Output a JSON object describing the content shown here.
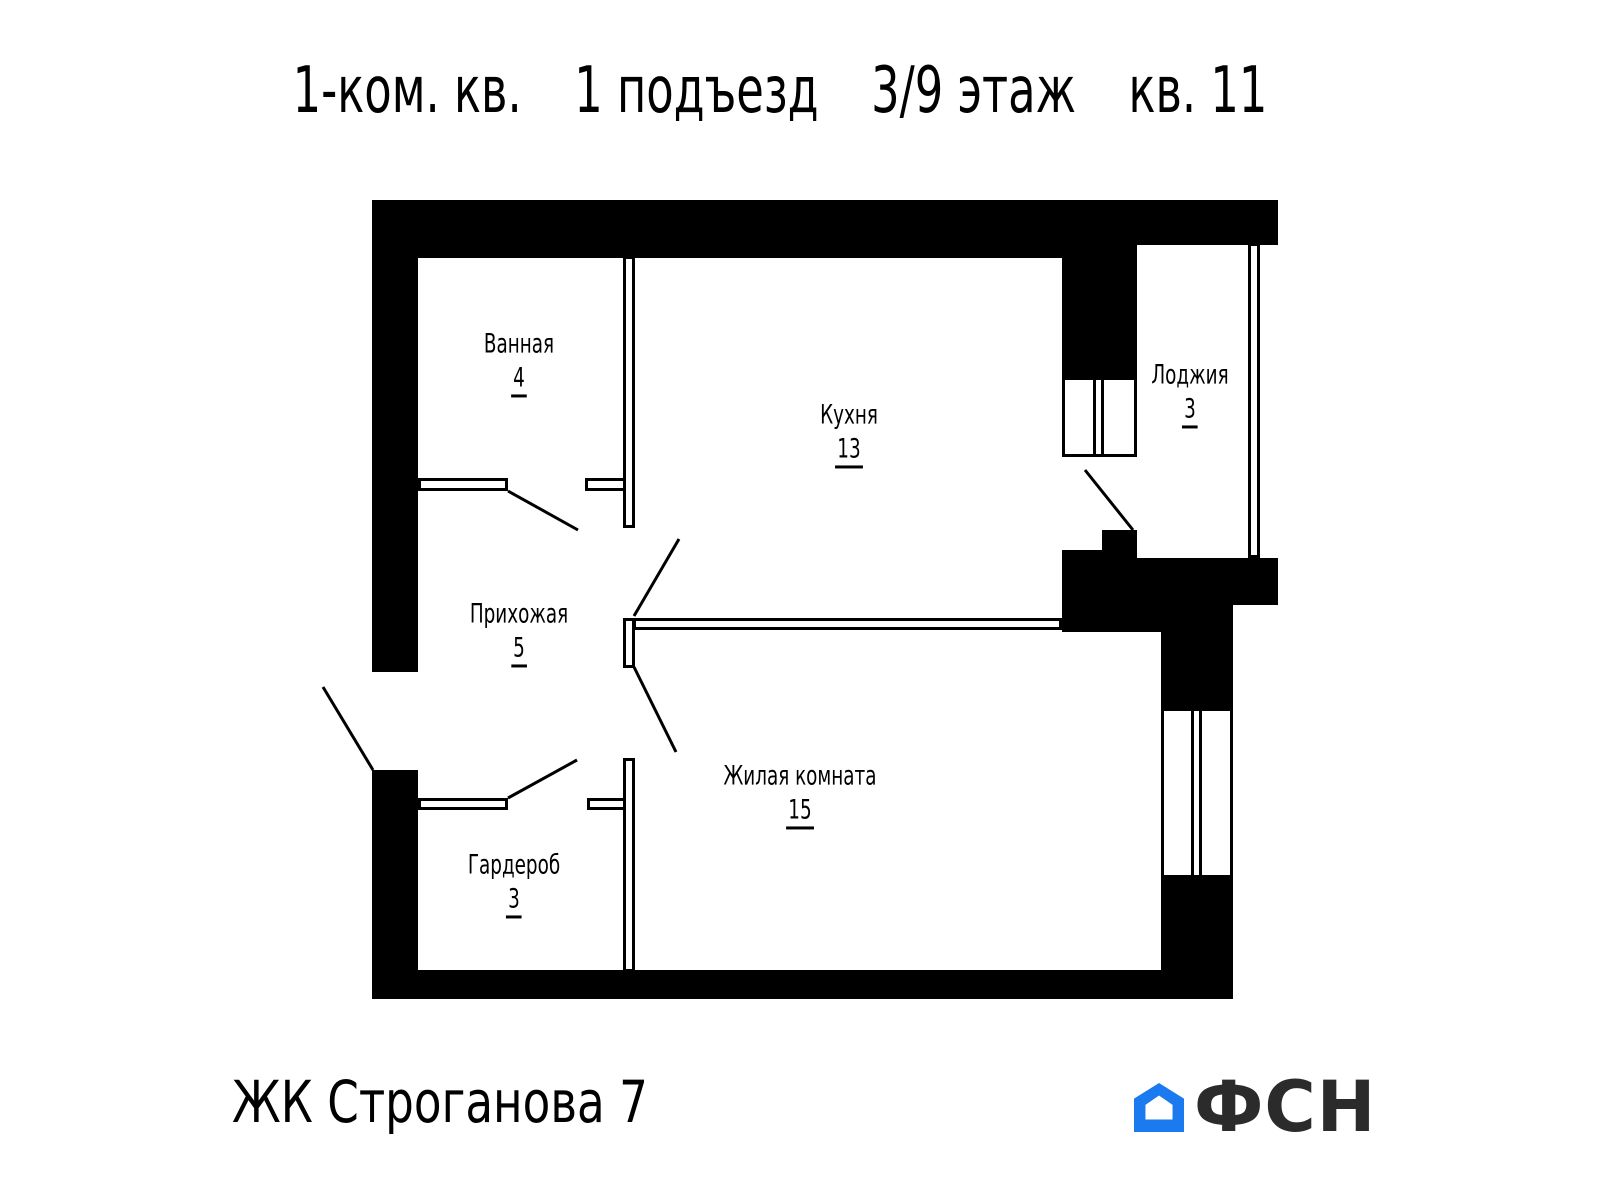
{
  "title": {
    "segments": [
      "1-ком. кв.",
      "1 подъезд",
      "3/9 этаж",
      "кв. 11"
    ]
  },
  "rooms": [
    {
      "name": "Ванная",
      "area": "4"
    },
    {
      "name": "Кухня",
      "area": "13"
    },
    {
      "name": "Лоджия",
      "area": "3"
    },
    {
      "name": "Прихожая",
      "area": "5"
    },
    {
      "name": "Жилая комната",
      "area": "15"
    },
    {
      "name": "Гардероб",
      "area": "3"
    }
  ],
  "footer": {
    "project": "ЖК Строганова 7",
    "logo_text": "ФСН"
  },
  "colors": {
    "walls": "#000000",
    "background": "#ffffff",
    "logo_blue": "#1b7af0",
    "logo_text": "#2b2b2b"
  }
}
